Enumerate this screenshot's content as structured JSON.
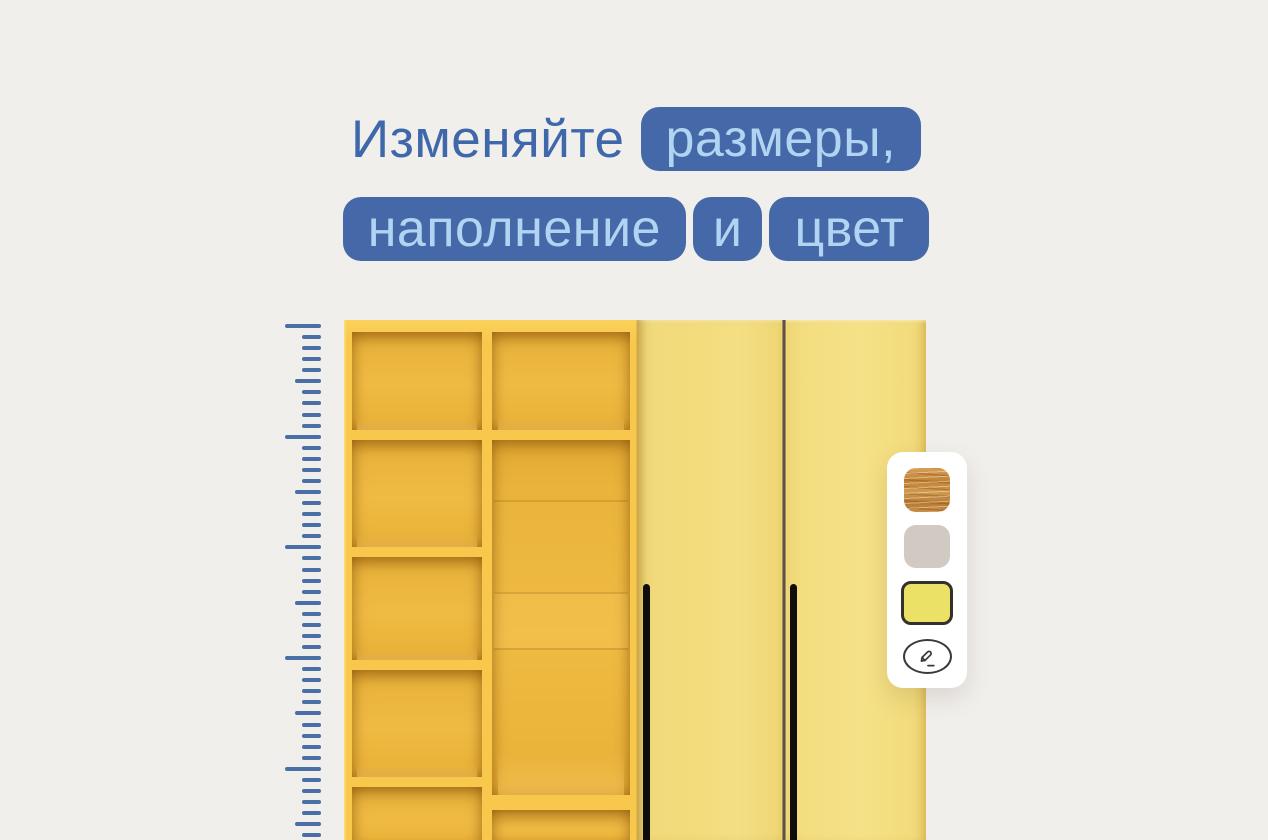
{
  "headline": {
    "line1_text": "Изменяйте",
    "line1_badge": "размеры,",
    "line2_badge_1": "наполнение",
    "line2_badge_2": "и",
    "line2_badge_3": "цвет"
  },
  "colors": {
    "background": "#f1efec",
    "headline_text": "#3f68ab",
    "badge_bg": "#4569a8",
    "badge_text": "#b0d4f1",
    "ruler_tick": "#4a6ea6",
    "shelf_frame": "#f8c84c",
    "shelf_interior": "#eeb63c",
    "door_yellow": "#f3dc7d",
    "handle_black": "#0e0d0b",
    "panel_bg": "#ffffff",
    "swatch_wood": "#c58c43",
    "swatch_gray": "#d1cac3",
    "swatch_yellow": "#ece167",
    "swatch_selected_border": "#35302c",
    "edit_icon_stroke": "#3a3a3a"
  },
  "ruler": {
    "orientation": "vertical",
    "tick_count": 47,
    "tick_spacing_px": 11.07,
    "major_every": 10,
    "medium_every": 5
  },
  "palette": {
    "swatches": [
      {
        "name": "wood",
        "selected": false
      },
      {
        "name": "gray",
        "selected": false
      },
      {
        "name": "yellow",
        "selected": true
      }
    ],
    "edit_icon": "pencil-icon"
  }
}
